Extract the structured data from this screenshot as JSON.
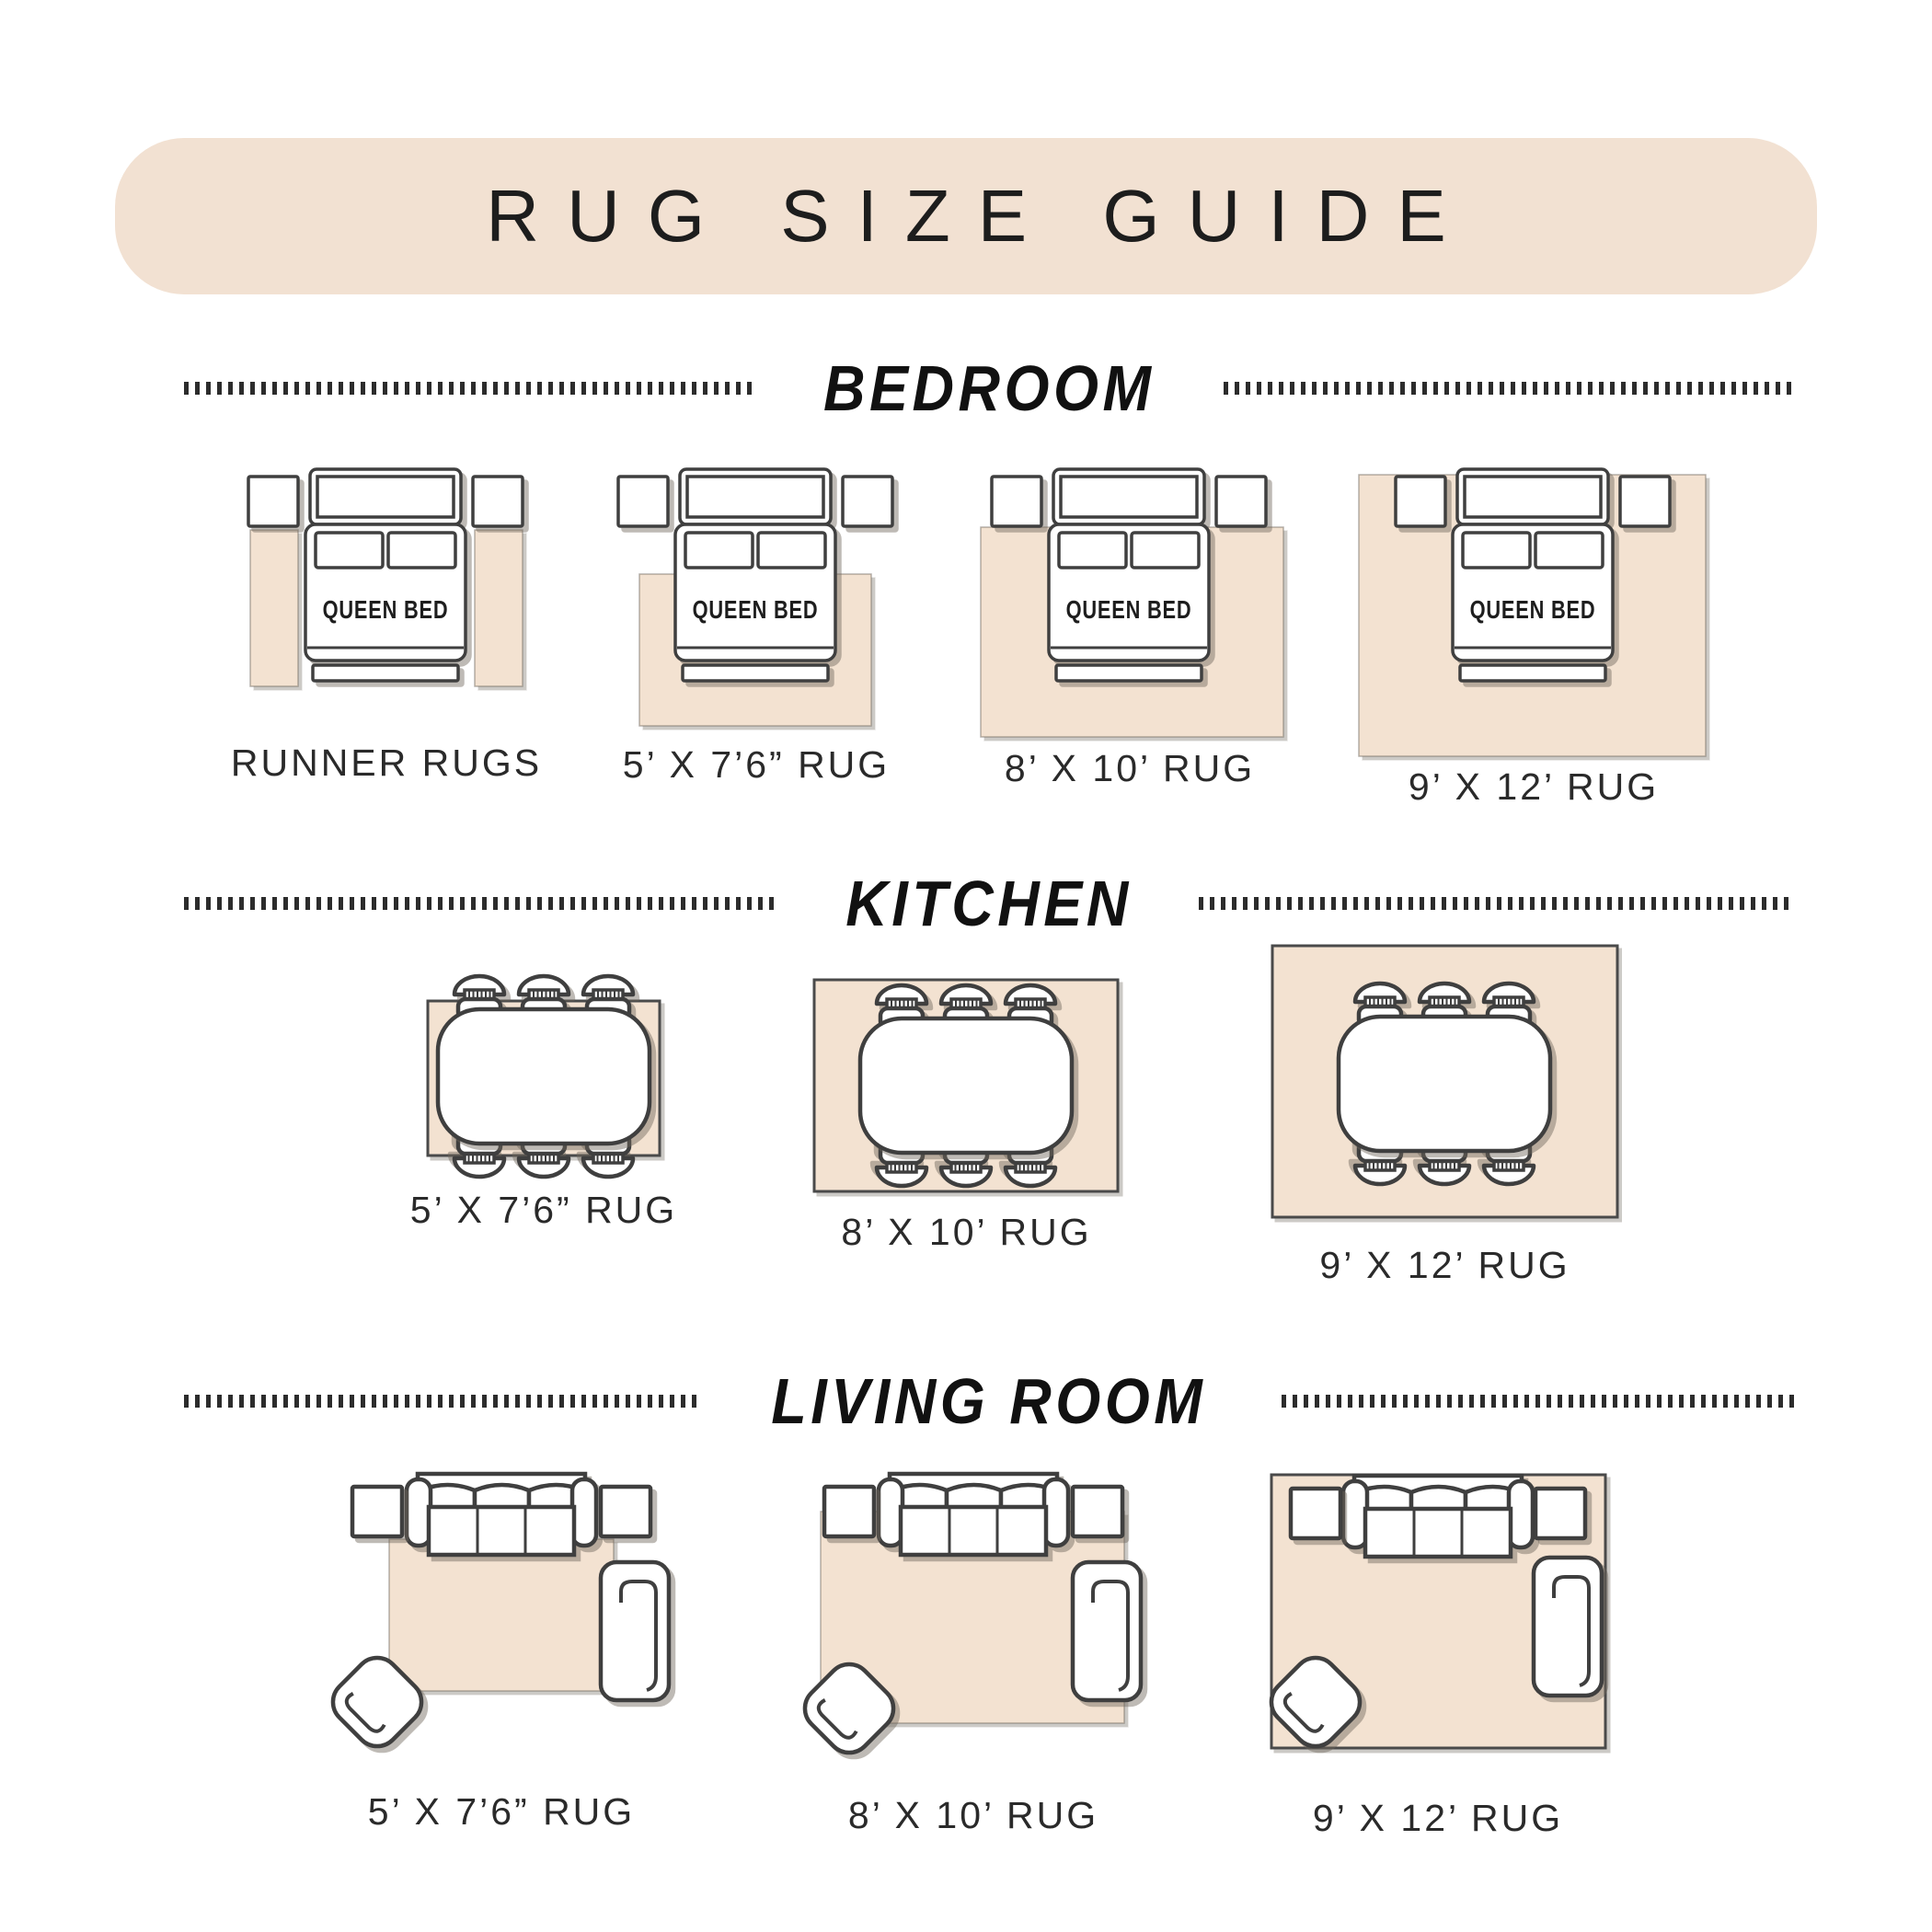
{
  "title": "RUG SIZE GUIDE",
  "bed_label": "QUEEN BED",
  "sections": [
    {
      "name": "BEDROOM",
      "diagrams": [
        {
          "label": "RUNNER RUGS",
          "icons": [
            "nightstand-icon",
            "nightstand-icon",
            "queen-bed-icon",
            "runner-rug",
            "runner-rug"
          ]
        },
        {
          "label": "5’ X 7’6” RUG",
          "icons": [
            "nightstand-icon",
            "nightstand-icon",
            "queen-bed-icon",
            "area-rug"
          ]
        },
        {
          "label": "8’ X 10’ RUG",
          "icons": [
            "nightstand-icon",
            "nightstand-icon",
            "queen-bed-icon",
            "area-rug"
          ]
        },
        {
          "label": "9’ X 12’ RUG",
          "icons": [
            "nightstand-icon",
            "nightstand-icon",
            "queen-bed-icon",
            "area-rug"
          ]
        }
      ]
    },
    {
      "name": "KITCHEN",
      "diagrams": [
        {
          "label": "5’ X 7’6” RUG",
          "icons": [
            "dining-table-icon",
            "chair-icon",
            "chair-icon",
            "chair-icon",
            "chair-icon",
            "chair-icon",
            "chair-icon",
            "area-rug"
          ]
        },
        {
          "label": "8’ X 10’ RUG",
          "icons": [
            "dining-table-icon",
            "chair-icon",
            "chair-icon",
            "chair-icon",
            "chair-icon",
            "chair-icon",
            "chair-icon",
            "area-rug"
          ]
        },
        {
          "label": "9’ X 12’ RUG",
          "icons": [
            "dining-table-icon",
            "chair-icon",
            "chair-icon",
            "chair-icon",
            "chair-icon",
            "chair-icon",
            "chair-icon",
            "area-rug"
          ]
        }
      ]
    },
    {
      "name": "LIVING ROOM",
      "diagrams": [
        {
          "label": "5’ X 7’6” RUG",
          "icons": [
            "sofa-icon",
            "end-table-icon",
            "end-table-icon",
            "chaise-icon",
            "armchair-icon",
            "area-rug"
          ]
        },
        {
          "label": "8’ X 10’ RUG",
          "icons": [
            "sofa-icon",
            "end-table-icon",
            "end-table-icon",
            "chaise-icon",
            "armchair-icon",
            "area-rug"
          ]
        },
        {
          "label": "9’ X 12’ RUG",
          "icons": [
            "sofa-icon",
            "end-table-icon",
            "end-table-icon",
            "chaise-icon",
            "armchair-icon",
            "area-rug"
          ]
        }
      ]
    }
  ],
  "colors": {
    "page_bg": "#ffffff",
    "banner_bg": "#f2e1d2",
    "rug": "#f3e2d1",
    "outline": "#3f3f3f",
    "rug_border": "#4a4a4a",
    "ink": "#1d1d1d",
    "label_ink": "#2a2a2a"
  }
}
